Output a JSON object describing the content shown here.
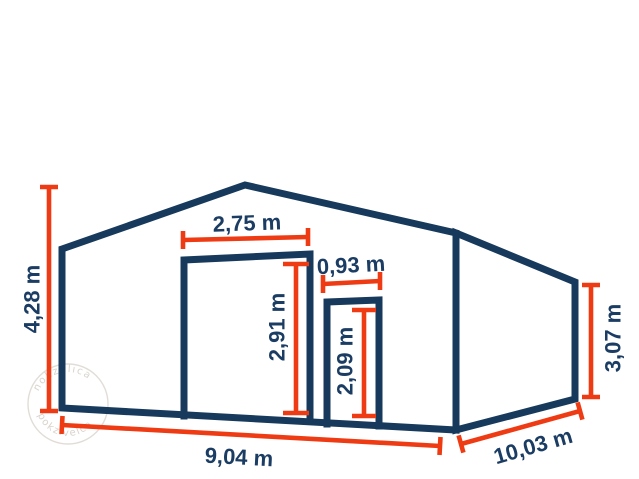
{
  "diagram": {
    "title": "storage-hall-dimension-diagram",
    "labels": {
      "total_height": "4,28 m",
      "large_door_width": "2,75 m",
      "large_door_height": "2,91 m",
      "small_door_width": "0,93 m",
      "small_door_height": "2,09 m",
      "eave_height": "3,07 m",
      "front_width": "9,04 m",
      "side_depth": "10,03 m"
    },
    "colors": {
      "structure_stroke": "#17395c",
      "dimension_stroke": "#ee3b13",
      "label_text": "#1b3c63",
      "watermark": "#b3a697",
      "background": "#ffffff"
    },
    "watermark": {
      "illegible_arc_text_top": "nokzvlıca",
      "illegible_arc_text_bottom": "pokzıvelca"
    }
  }
}
